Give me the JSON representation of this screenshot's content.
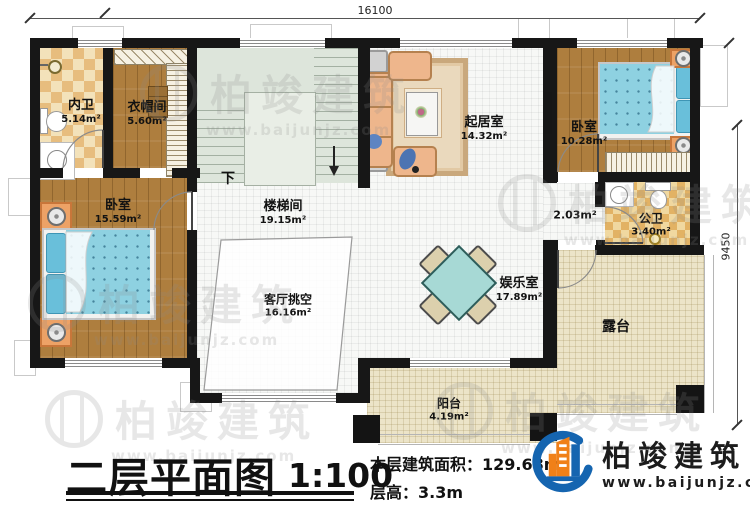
{
  "plan": {
    "dimension_top": "16100",
    "dimension_right": "9450",
    "stair_down": "下",
    "rooms": {
      "inner_bath": {
        "name": "内卫",
        "area": "5.14m²"
      },
      "cloakroom": {
        "name": "衣帽间",
        "area": "5.60m²"
      },
      "bedroom_left": {
        "name": "卧室",
        "area": "15.59m²"
      },
      "stairwell": {
        "name": "楼梯间",
        "area": "19.15m²"
      },
      "void": {
        "name": "客厅挑空",
        "area": "16.16m²"
      },
      "living": {
        "name": "起居室",
        "area": "14.32m²"
      },
      "bedroom_right": {
        "name": "卧室",
        "area": "10.28m²"
      },
      "public_bath": {
        "name": "公卫",
        "area": "3.40m²"
      },
      "hall_area": {
        "area": "2.03m²"
      },
      "recreation": {
        "name": "娱乐室",
        "area": "17.89m²"
      },
      "terrace": {
        "name": "露台"
      },
      "balcony": {
        "name": "阳台",
        "area": "4.19m²"
      }
    }
  },
  "titleblock": {
    "title": "二层平面图",
    "scale": "1:100",
    "area_label": "本层建筑面积：",
    "area_value": "129.68m²",
    "floor_height": "层高：3.3m"
  },
  "brand": {
    "name": "柏竣建筑",
    "website": "www.baijunjz.com"
  },
  "watermark": {
    "name": "柏竣建筑",
    "website": "www.baijunjz.com"
  },
  "colors": {
    "wall": "#171717",
    "wood": "#ae7e3e",
    "bath_tile": "#e7bd7e",
    "bed": "#8ed1e1",
    "stair": "#dde5db",
    "terrace": "#ece4c8",
    "logo_blue": "#1565b0",
    "logo_orange": "#f08018"
  }
}
